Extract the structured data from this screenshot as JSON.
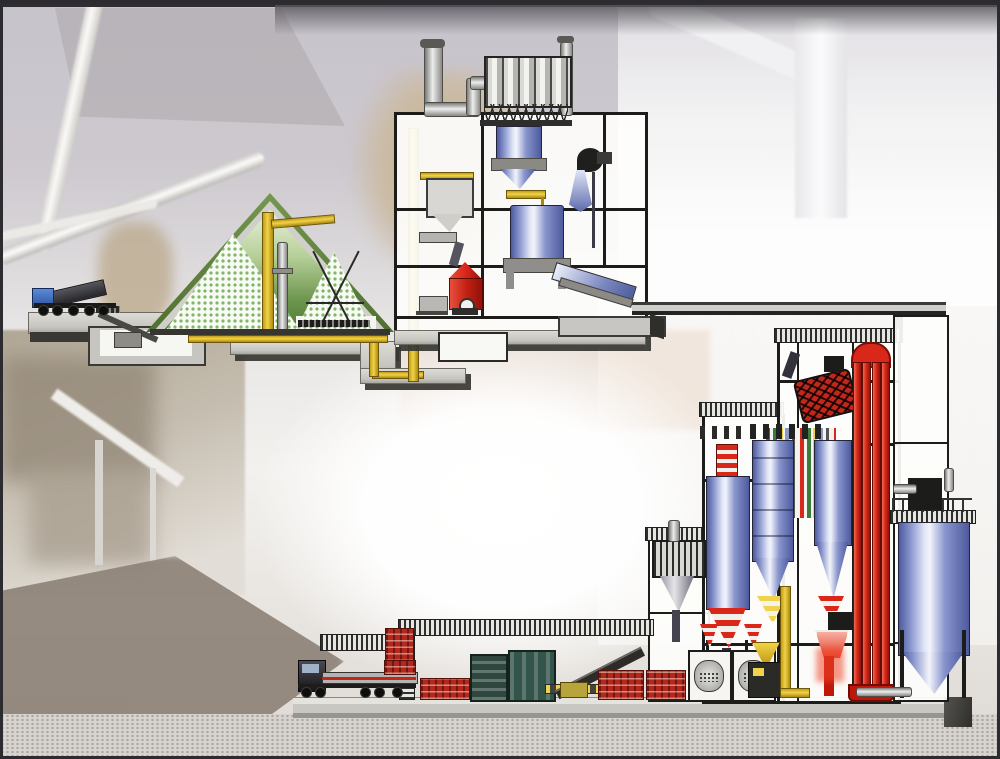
{
  "meta": {
    "type": "technical-illustration",
    "subject": "cutaway diagram of a milling / bagging plant over a photographic plant background",
    "visible_text": ""
  },
  "palette": {
    "ink": "#1c1c1a",
    "conc-l": "#dcdbd6",
    "conc": "#c6c5bf",
    "conc-d": "#393834",
    "yellow": "#f0d34a",
    "yellow-d": "#a8870e",
    "red": "#d9281a",
    "red-d": "#7a1008",
    "blue-d": "#4d5a9e",
    "blue-m": "#8894cc",
    "blue-hl": "#f2f4fb",
    "green-roof": "#4f7030",
    "green-wall": "#5d8440",
    "checker": "#7ab264",
    "hatch-d": "#2e2e2c",
    "hatch-l": "#e6e6e3",
    "sky": "#c7c3cb",
    "gravel": "#d7d3ce"
  },
  "components": {
    "intake": [
      "dump-truck",
      "intake-hopper",
      "underground-pit",
      "incline-conveyor",
      "loader"
    ],
    "storage_dome": [
      "a-frame-roof",
      "stockpile-left",
      "stockpile-right",
      "portal-scraper",
      "elevator-column",
      "boom-conveyor",
      "reclaim-conveyor"
    ],
    "mill_tower": [
      "exhaust-stack",
      "bag-filter",
      "cyclone",
      "dryer-drum",
      "roller-mill",
      "feed-bin",
      "process-fan",
      "discharge-chute",
      "bucket-elevator"
    ],
    "transfer": [
      "conveyor-bridge",
      "underground-gallery"
    ],
    "main_building": [
      "blue-silos",
      "vertical-pipe-bundle",
      "rotary-sifter",
      "bucket-elevator",
      "bag-packers",
      "mixers",
      "dust-filter",
      "cyclone-annex"
    ],
    "finished_silo": [
      "storage-silo",
      "top-filter",
      "discharge-conveyor"
    ],
    "dispatch": [
      "flatbed-truck",
      "bag-pallets",
      "palletizers",
      "loading-canopy",
      "bag-conveyor"
    ]
  }
}
